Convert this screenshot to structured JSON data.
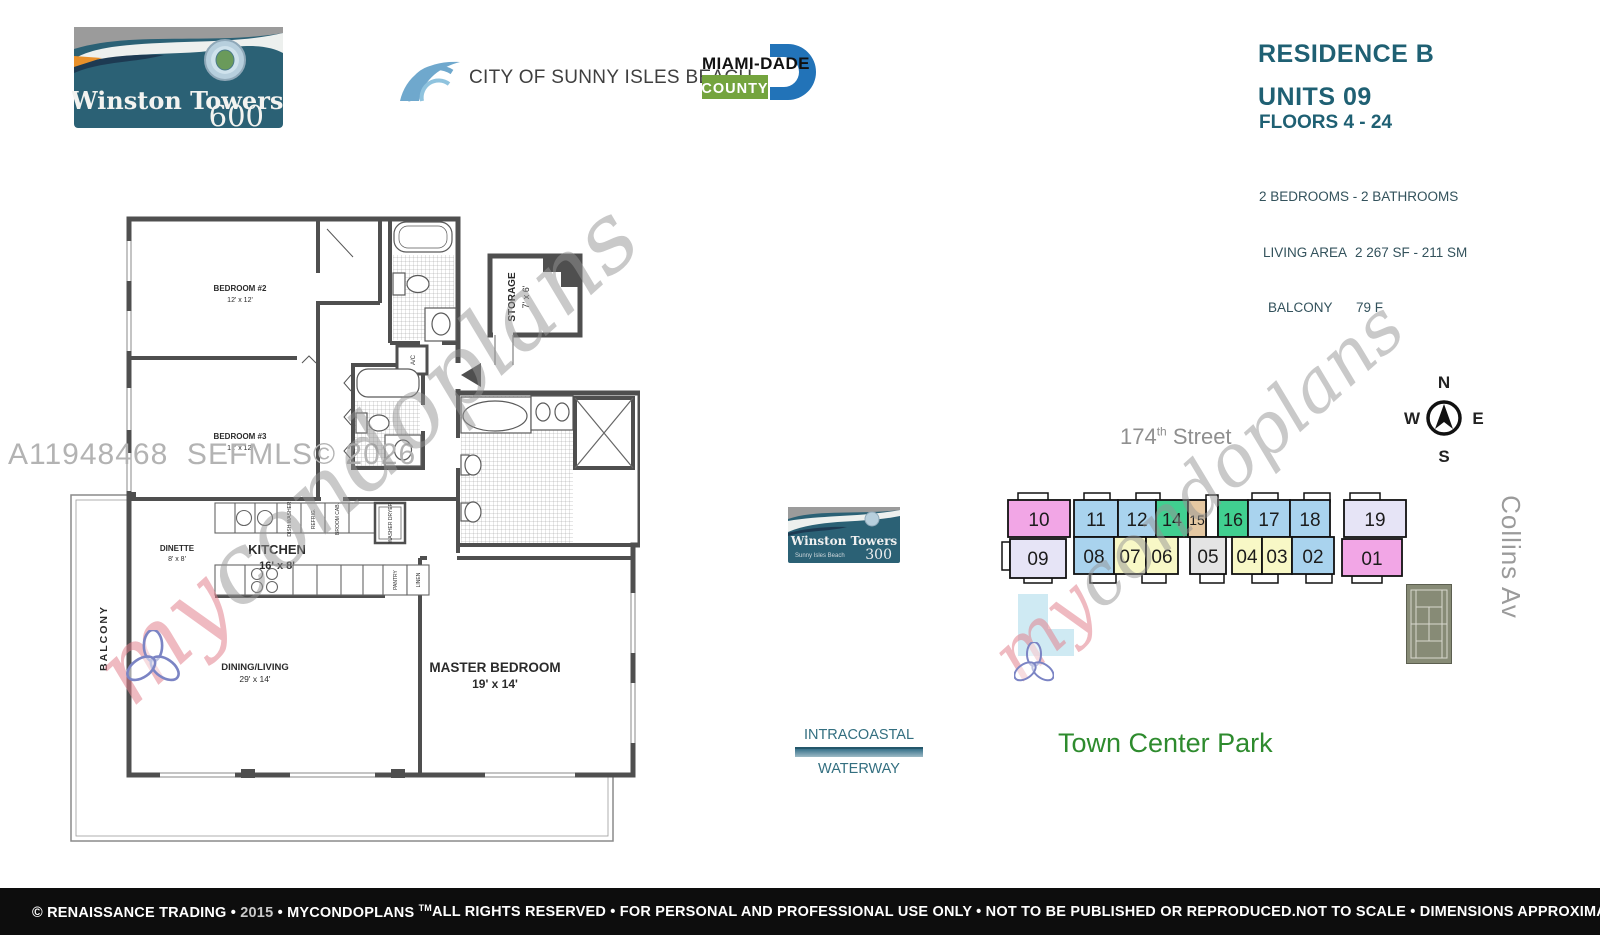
{
  "colors": {
    "teal_heading": "#1f6073",
    "logo_teal": "#2b6175",
    "county_green": "#74a43e",
    "county_blue": "#2273b8",
    "park_green": "#2e8b2e",
    "water_teal": "#336f80",
    "street_gray": "#8f8f8f",
    "footer_bg": "#0d0d0d",
    "unit_pink": "#f2a6e6",
    "unit_blue": "#a9d3ee",
    "unit_green": "#41cf90",
    "unit_tan": "#e5c8a2",
    "unit_yellow": "#f8f8c6",
    "unit_lavender": "#e6e4f6",
    "unit_gray": "#e4e4e4"
  },
  "header": {
    "tower600": {
      "name": "Winston Towers",
      "number": "600"
    },
    "city": "CITY OF SUNNY ISLES BEACH",
    "county": {
      "name": "MIAMI-DADE",
      "sub": "COUNTY"
    },
    "residence": "RESIDENCE B",
    "units": "UNITS 09",
    "floors": "FLOORS 4 - 24",
    "specs": [
      {
        "label": "2 BEDROOMS - 2 BATHROOMS",
        "value": ""
      },
      {
        "label": "LIVING AREA",
        "value": "2 267 SF - 211 SM"
      },
      {
        "label": "BALCONY",
        "value": "79 F"
      }
    ]
  },
  "floorplan": {
    "mls_watermark": "A11948468  SEFMLS© 2026",
    "rooms": {
      "bedroom2": {
        "name": "BEDROOM #2",
        "dims": "12' x 12'"
      },
      "bedroom3": {
        "name": "BEDROOM #3",
        "dims": "12' x 12'"
      },
      "storage": {
        "name": "STORAGE",
        "dims": "7' x 6'"
      },
      "dinette": {
        "name": "DINETTE",
        "dims": "8' x 8'"
      },
      "kitchen": {
        "name": "KITCHEN",
        "dims": "16' x 8'"
      },
      "dining": {
        "name": "DINING/LIVING",
        "dims": "29' x 14'"
      },
      "master": {
        "name": "MASTER BEDROOM",
        "dims": "19' x 14'"
      },
      "balcony": "BALCONY"
    },
    "fixtures": {
      "dishwasher": "DISH WASHER",
      "refrigerator": "REFRIG.",
      "cabinet": "BROOM CAB.",
      "washer_dryer": "WASHER DRYER",
      "pantry": "PANTRY",
      "linen": "LINEN",
      "ac": "A/C"
    }
  },
  "watermark": {
    "script_my": "my",
    "script_rest": "condoplans"
  },
  "sitemap": {
    "street": {
      "num": "174",
      "sup": "th",
      "name": " Street"
    },
    "compass": {
      "n": "N",
      "e": "E",
      "s": "S",
      "w": "W"
    },
    "tower300": {
      "name": "Winston Towers",
      "sub": "Sunny Isles Beach",
      "number": "300"
    },
    "units_top": [
      {
        "label": "10",
        "color": "#f2a6e6"
      },
      {
        "label": "11",
        "color": "#a9d3ee"
      },
      {
        "label": "12",
        "color": "#a9d3ee"
      },
      {
        "label": "14",
        "color": "#41cf90"
      },
      {
        "label": "15",
        "color": "#e5c8a2"
      },
      {
        "label": "16",
        "color": "#41cf90"
      },
      {
        "label": "17",
        "color": "#a9d3ee"
      },
      {
        "label": "18",
        "color": "#a9d3ee"
      },
      {
        "label": "19",
        "color": "#e6e4f6"
      }
    ],
    "units_bottom": [
      {
        "label": "09",
        "color": "#e6e4f6"
      },
      {
        "label": "08",
        "color": "#a9d3ee"
      },
      {
        "label": "07",
        "color": "#f8f8c6"
      },
      {
        "label": "06",
        "color": "#f8f8c6"
      },
      {
        "label": "05",
        "color": "#e4e4e4"
      },
      {
        "label": "04",
        "color": "#f8f8c6"
      },
      {
        "label": "03",
        "color": "#f8f8c6"
      },
      {
        "label": "02",
        "color": "#a9d3ee"
      },
      {
        "label": "01",
        "color": "#f2a6e6"
      }
    ],
    "collins": "Collins Av",
    "park": "Town Center Park",
    "waterway": {
      "line1": "INTRACOASTAL",
      "line2": "WATERWAY"
    }
  },
  "footer": {
    "copyright_pre": "© RENAISSANCE TRADING • ",
    "year": "2015",
    "copyright_post": " • MYCONDOPLANS ",
    "tm": "TM",
    "center": "ALL RIGHTS RESERVED • FOR PERSONAL AND PROFESSIONAL USE ONLY • NOT TO BE PUBLISHED OR REPRODUCED.",
    "right": "NOT TO SCALE • DIMENSIONS APPROXIMATE"
  }
}
